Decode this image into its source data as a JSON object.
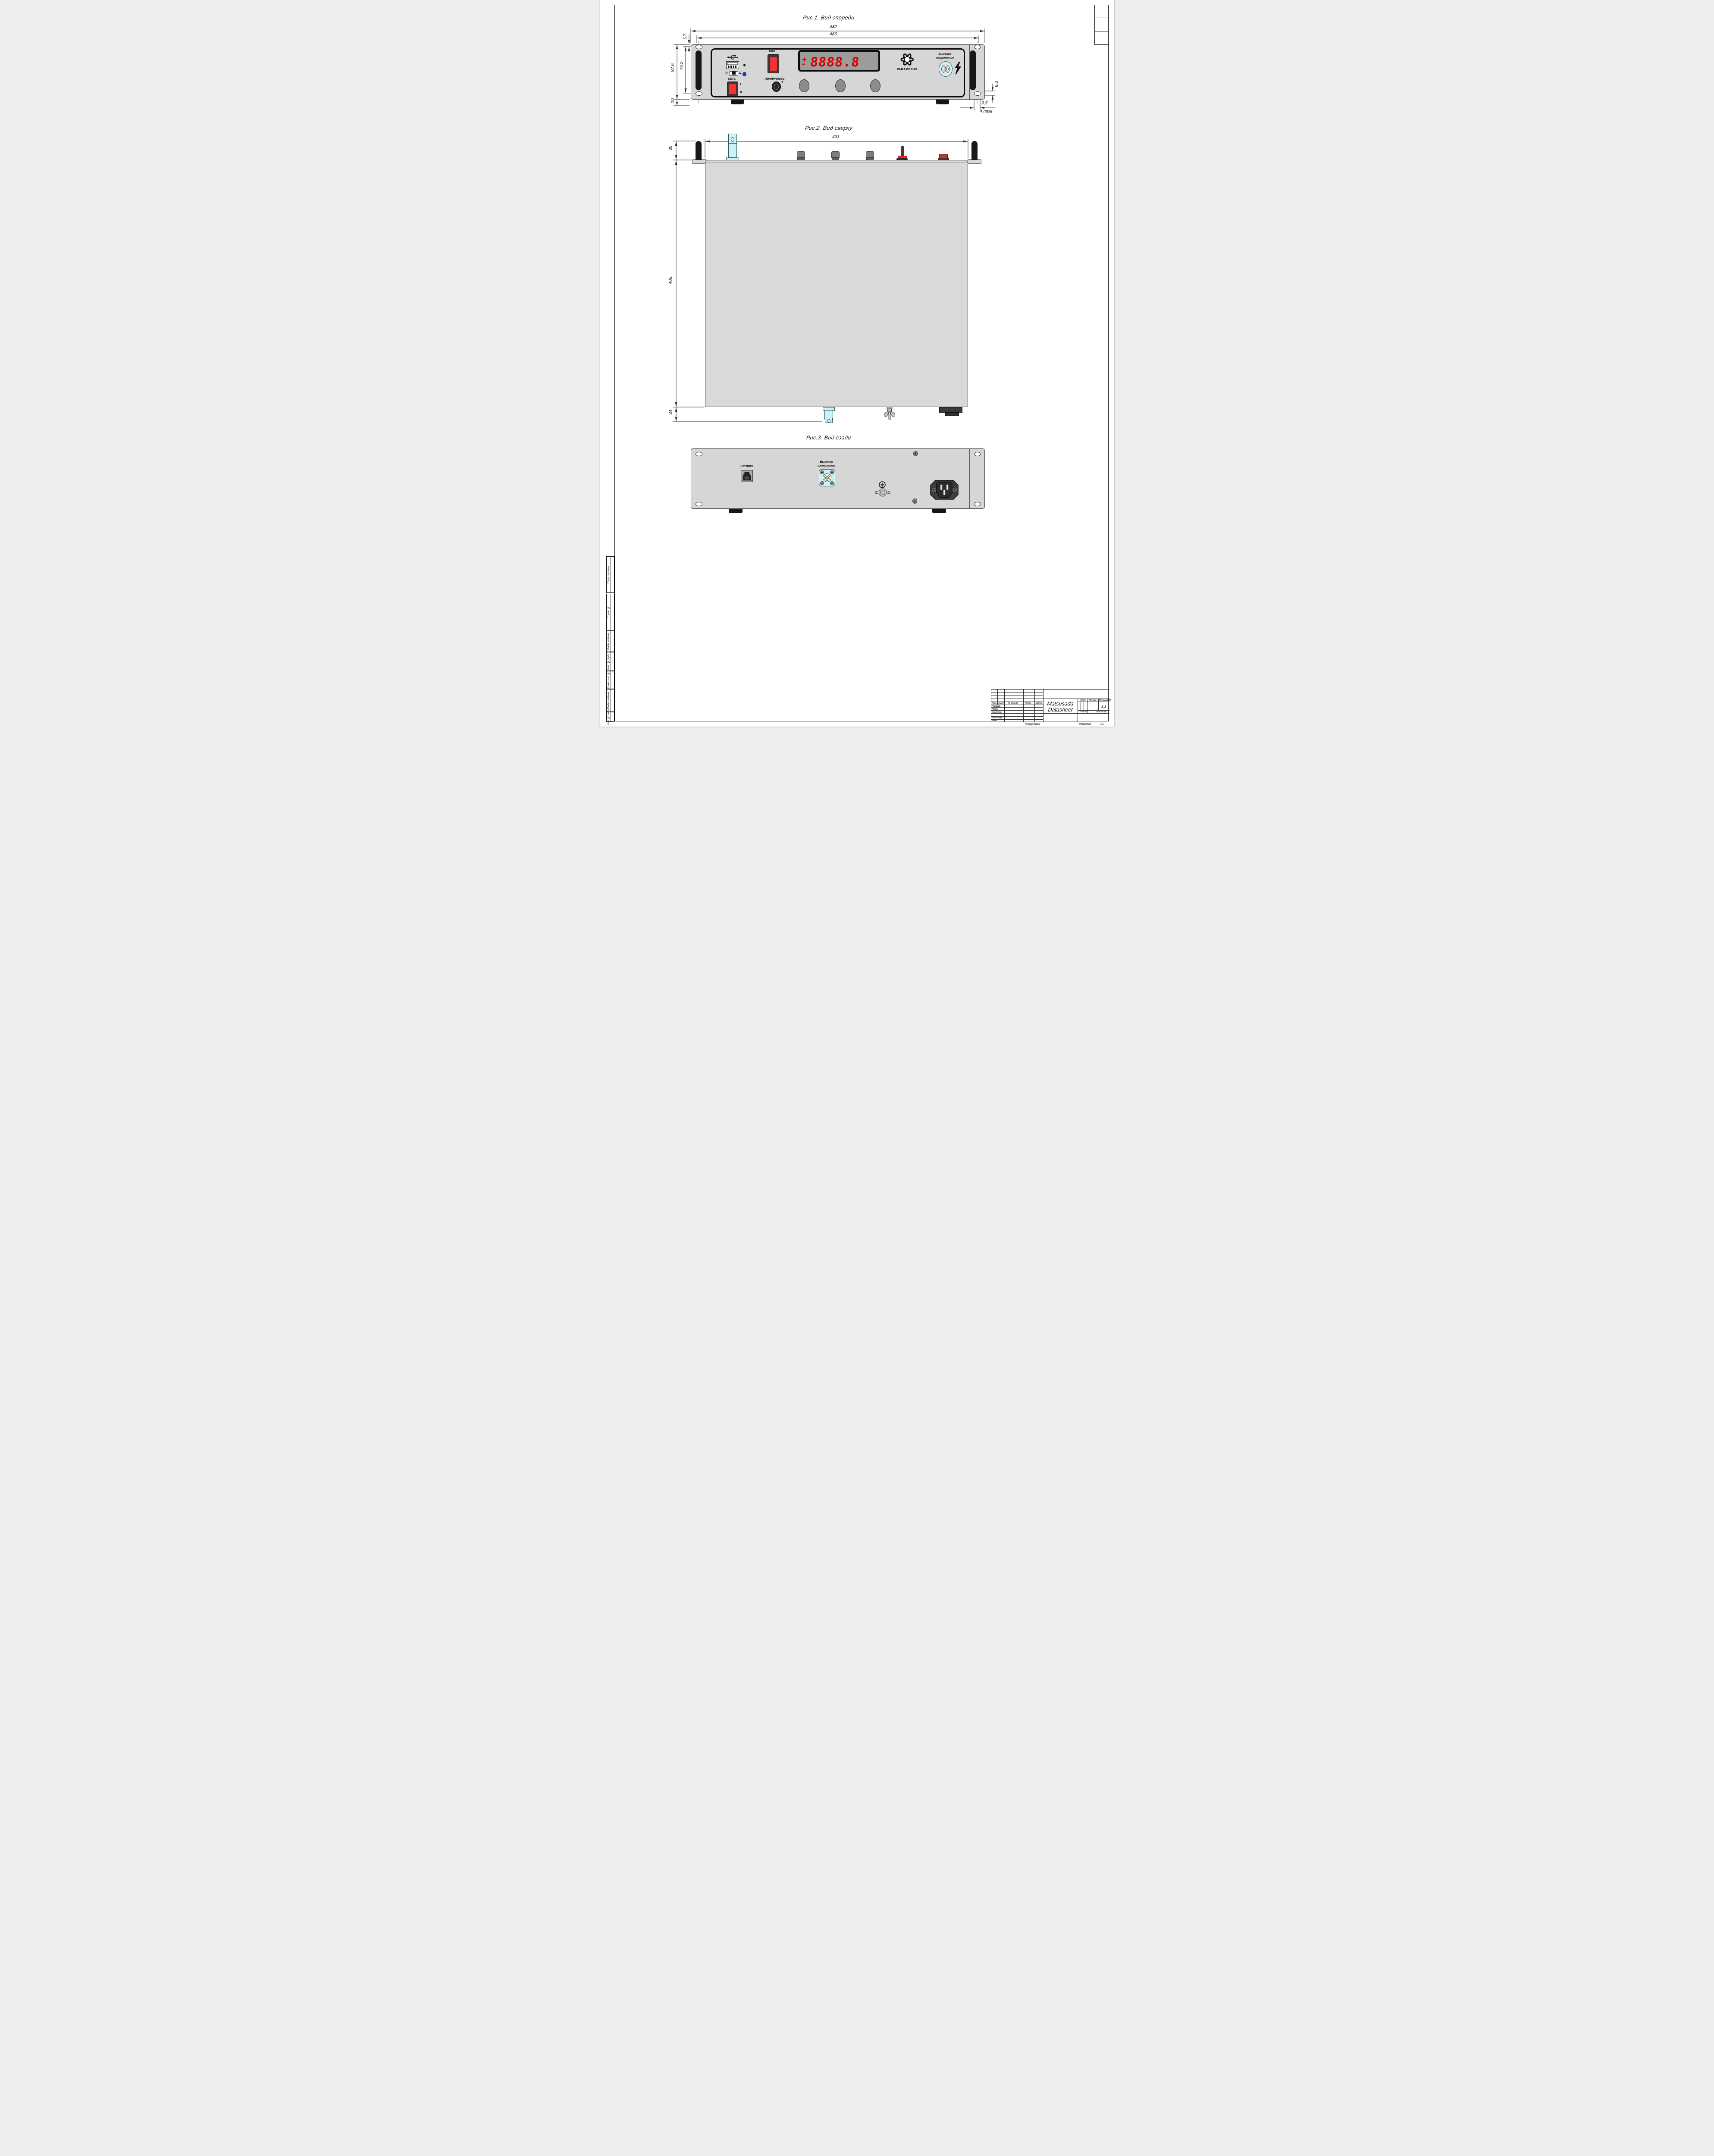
{
  "figures": {
    "front": "Рис.1. Вид спереди",
    "top": "Рис.2. Вид сверху",
    "rear": "Рис.3. Вид сзади"
  },
  "dims": {
    "overall_width": "482",
    "face_width": "466",
    "top_to_slot": "5,7",
    "overall_height": "87,6",
    "slot_spacing": "76,2",
    "foot_height": "10",
    "slot_height": "6,3",
    "slot_width": "9,5",
    "slots_note": "4 паза",
    "top_width": "431",
    "handle_depth": "30",
    "body_depth": "405",
    "rear_protrusion": "24"
  },
  "front_panel": {
    "power_button": "ВКЛ",
    "mains_switch": "СЕТЬ",
    "mains_on": "I",
    "mains_off": "0",
    "polarity": "ПОЛЯРНОСТЬ",
    "plus": "+",
    "minus": "-",
    "usb_mode_a": "А",
    "usb_mode_c": "Ц",
    "display_sign": "+",
    "display_sign2": "-",
    "display_value": "8888.8",
    "brand": "PARAMERUS",
    "hv_line1": "Высокое",
    "hv_line2": "напряжение"
  },
  "rear_panel": {
    "ethernet": "Ethernet",
    "hv_line1": "Высокое",
    "hv_line2": "напряжение"
  },
  "title_block": {
    "product_line1": "Matsusada",
    "product_line2": "Datasheet",
    "col_izm": "Изм.",
    "col_list": "Лист",
    "col_doc": "№ докум.",
    "col_sign": "Подп.",
    "col_date": "Дата",
    "row_razrab": "Разраб.",
    "row_prov": "Пров.",
    "row_tkontr": "Т.контр.",
    "row_nkontr": "Н.контр.",
    "row_utv": "Утв.",
    "lit": "Лит.",
    "massa": "Масса",
    "scale": "Масштаб",
    "scale_value": "1:1",
    "list": "Лист",
    "listov": "Листов",
    "listov_value": "1",
    "copied": "Копировал",
    "format": "Формат",
    "format_value": "А0"
  },
  "margin_labels": [
    "Перв. примен.",
    "Справ. №",
    "Подп. и дата",
    "Инв. № дубл.",
    "Взам. инв. №",
    "Подп. и дата",
    "Инв. № подл."
  ]
}
